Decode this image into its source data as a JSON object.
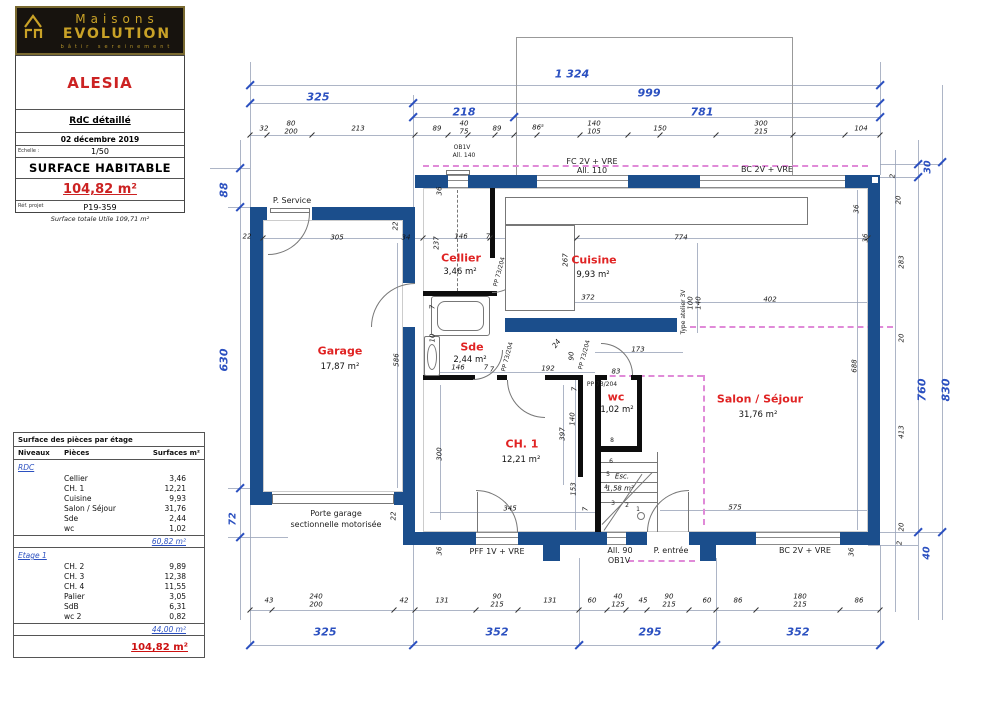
{
  "brand": {
    "line1": "Maisons",
    "line2": "EVOLUTION",
    "tagline": "bâtir sereinement"
  },
  "title_block": {
    "project": "ALESIA",
    "drawing": "RdC détaillé",
    "date": "02 décembre 2019",
    "scale_label": "Echelle :",
    "scale": "1/50",
    "surface_title": "SURFACE HABITABLE",
    "surface_value": "104,82 m²",
    "ref_label": "Réf. projet",
    "ref": "P19-359"
  },
  "note": "Surface totale Utile 109,71 m²",
  "surface_table": {
    "title": "Surface des pièces par étage",
    "columns": [
      "Niveaux",
      "Pièces",
      "Surfaces m²"
    ],
    "sections": [
      {
        "level": "RDC",
        "rows": [
          [
            "Cellier",
            "3,46"
          ],
          [
            "CH. 1",
            "12,21"
          ],
          [
            "Cuisine",
            "9,93"
          ],
          [
            "Salon / Séjour",
            "31,76"
          ],
          [
            "Sde",
            "2,44"
          ],
          [
            "wc",
            "1,02"
          ]
        ],
        "subtotal": "60,82 m²"
      },
      {
        "level": "Etage 1",
        "rows": [
          [
            "CH. 2",
            "9,89"
          ],
          [
            "CH. 3",
            "12,38"
          ],
          [
            "CH. 4",
            "11,55"
          ],
          [
            "Palier",
            "3,05"
          ],
          [
            "SdB",
            "6,31"
          ],
          [
            "wc 2",
            "0,82"
          ]
        ],
        "subtotal": "44,00 m²"
      }
    ],
    "total": "104,82 m²"
  },
  "colors": {
    "wall": "#1b4e8c",
    "dim_total": "#2b50c0",
    "room_label": "#e02323",
    "ceiling_dash": "#e08ad8",
    "brand_gold": "#c9a227",
    "logo_bg": "#17130e"
  },
  "plan": {
    "labels": [
      [
        "1 324",
        "total",
        572,
        74
      ],
      [
        "325",
        "total",
        318,
        97
      ],
      [
        "999",
        "total",
        649,
        93
      ],
      [
        "218",
        "total",
        464,
        112
      ],
      [
        "781",
        "total",
        702,
        112
      ],
      [
        "32",
        "dim",
        264,
        129
      ],
      [
        "80",
        "dim",
        291,
        124
      ],
      [
        "200",
        "dim",
        291,
        132
      ],
      [
        "213",
        "dim",
        358,
        129
      ],
      [
        "89",
        "dim",
        437,
        129
      ],
      [
        "40",
        "dim",
        464,
        124
      ],
      [
        "75",
        "dim",
        464,
        132
      ],
      [
        "OB1V",
        "tiny",
        462,
        148
      ],
      [
        "All. 140",
        "tiny",
        464,
        156
      ],
      [
        "89",
        "dim",
        497,
        129
      ],
      [
        "86⁵",
        "dim",
        538,
        128
      ],
      [
        "140",
        "dim",
        594,
        124
      ],
      [
        "105",
        "dim",
        594,
        132
      ],
      [
        "150",
        "dim",
        660,
        129
      ],
      [
        "300",
        "dim",
        761,
        124
      ],
      [
        "215",
        "dim",
        761,
        132
      ],
      [
        "104",
        "dim",
        861,
        129
      ],
      [
        "FC 2V + VRE",
        "ann",
        592,
        162
      ],
      [
        "All. 110",
        "ann",
        592,
        171
      ],
      [
        "BC 2V + VRE",
        "ann",
        767,
        170
      ],
      [
        "P. Service",
        "ann",
        292,
        201
      ],
      [
        "88",
        "total",
        224,
        190,
        -90
      ],
      [
        "630",
        "total",
        224,
        360,
        -90
      ],
      [
        "72",
        "total2",
        233,
        519,
        -90
      ],
      [
        "22",
        "dim",
        247,
        237
      ],
      [
        "305",
        "dim",
        337,
        238
      ],
      [
        "34",
        "dim",
        406,
        238
      ],
      [
        "22",
        "dim",
        396,
        226,
        -90
      ],
      [
        "586",
        "dim",
        397,
        360,
        -90
      ],
      [
        "Garage",
        "room",
        340,
        351
      ],
      [
        "17,87 m²",
        "area",
        340,
        367
      ],
      [
        "22",
        "dim",
        394,
        516,
        -90
      ],
      [
        "36",
        "dim",
        440,
        551,
        -90
      ],
      [
        "36",
        "dim",
        440,
        191,
        -90
      ],
      [
        "237",
        "dim",
        437,
        243,
        -90
      ],
      [
        "146",
        "dim",
        461,
        237
      ],
      [
        "7",
        "dim",
        488,
        237
      ],
      [
        "Cellier",
        "room",
        461,
        258
      ],
      [
        "3,46 m²",
        "area",
        460,
        272
      ],
      [
        "PP 73/204",
        "tiny",
        500,
        272,
        -75
      ],
      [
        "Sde",
        "room",
        472,
        347
      ],
      [
        "2,44 m²",
        "area",
        470,
        360
      ],
      [
        "146",
        "dim",
        458,
        368
      ],
      [
        "7",
        "dim",
        486,
        368
      ],
      [
        "7",
        "dim",
        433,
        307,
        -90
      ],
      [
        "10",
        "dim",
        433,
        338,
        -90
      ],
      [
        "PP 73/204",
        "tiny",
        508,
        357,
        -75
      ],
      [
        "Cuisine",
        "room",
        594,
        260
      ],
      [
        "9,93 m²",
        "area",
        593,
        275
      ],
      [
        "267",
        "dim",
        566,
        260,
        -90
      ],
      [
        "774",
        "dim",
        681,
        238
      ],
      [
        "36",
        "dim",
        866,
        238,
        -90
      ],
      [
        "372",
        "dim",
        588,
        298
      ],
      [
        "402",
        "dim",
        770,
        300
      ],
      [
        "100",
        "dim",
        691,
        303,
        -90
      ],
      [
        "140",
        "dim",
        699,
        303,
        -90
      ],
      [
        "Type atelier 3V",
        "tiny",
        684,
        312,
        -90
      ],
      [
        "36",
        "dim",
        857,
        209,
        -90
      ],
      [
        "192",
        "dim",
        548,
        369
      ],
      [
        "24",
        "dim",
        557,
        344,
        -55
      ],
      [
        "90",
        "dim",
        572,
        356,
        -90
      ],
      [
        "PP 73/204",
        "tiny",
        585,
        355,
        -75
      ],
      [
        "173",
        "dim",
        638,
        350
      ],
      [
        "83",
        "dim",
        616,
        372
      ],
      [
        "PP 73/204",
        "tiny",
        602,
        385
      ],
      [
        "wc",
        "room",
        616,
        397
      ],
      [
        "1,02 m²",
        "area",
        617,
        410
      ],
      [
        "8",
        "tiny",
        612,
        441
      ],
      [
        "6",
        "tiny",
        611,
        462
      ],
      [
        "5",
        "tiny",
        608,
        475
      ],
      [
        "Esc.",
        "esc",
        622,
        477
      ],
      [
        "4",
        "tiny",
        606,
        488
      ],
      [
        "1,58 m²",
        "esc",
        620,
        489
      ],
      [
        "3",
        "tiny",
        613,
        504
      ],
      [
        "2",
        "tiny",
        627,
        506
      ],
      [
        "1",
        "tiny",
        638,
        510
      ],
      [
        "140",
        "dim",
        573,
        419,
        -90
      ],
      [
        "397",
        "dim",
        563,
        434,
        -90
      ],
      [
        "7",
        "dim",
        575,
        389,
        -90
      ],
      [
        "153",
        "dim",
        574,
        489,
        -90
      ],
      [
        "7",
        "dim",
        586,
        509,
        -90
      ],
      [
        "CH. 1",
        "room",
        522,
        444
      ],
      [
        "12,21 m²",
        "area",
        521,
        460
      ],
      [
        "300",
        "dim",
        440,
        454,
        -90
      ],
      [
        "345",
        "dim",
        510,
        509
      ],
      [
        "7",
        "dim",
        492,
        370
      ],
      [
        "Salon / Séjour",
        "room",
        760,
        399
      ],
      [
        "31,76 m²",
        "area",
        758,
        415
      ],
      [
        "688",
        "dim",
        855,
        366,
        -90
      ],
      [
        "575",
        "dim",
        735,
        508
      ],
      [
        "30",
        "total2",
        928,
        167,
        -90
      ],
      [
        "2",
        "dim",
        893,
        176,
        -90
      ],
      [
        "20",
        "dim",
        899,
        200,
        -90
      ],
      [
        "283",
        "dim",
        902,
        262,
        -90
      ],
      [
        "20",
        "dim",
        902,
        338,
        -90
      ],
      [
        "413",
        "dim",
        902,
        432,
        -90
      ],
      [
        "760",
        "total",
        922,
        390,
        -90
      ],
      [
        "830",
        "total",
        946,
        390,
        -90
      ],
      [
        "20",
        "dim",
        902,
        527,
        -90
      ],
      [
        "2",
        "dim",
        900,
        543,
        -90
      ],
      [
        "40",
        "total2",
        927,
        553,
        -90
      ],
      [
        "36",
        "dim",
        852,
        552,
        -90
      ],
      [
        "Porte garage",
        "ann",
        336,
        514
      ],
      [
        "sectionnelle motorisée",
        "ann",
        336,
        525
      ],
      [
        "PFF 1V + VRE",
        "ann",
        497,
        552
      ],
      [
        "All. 90",
        "ann",
        620,
        551
      ],
      [
        "OB1V",
        "ann",
        619,
        561
      ],
      [
        "P. entrée",
        "ann",
        671,
        551
      ],
      [
        "BC 2V + VRE",
        "ann",
        805,
        551
      ],
      [
        "43",
        "dim",
        269,
        601
      ],
      [
        "240",
        "dim",
        316,
        597
      ],
      [
        "200",
        "dim",
        316,
        605
      ],
      [
        "42",
        "dim",
        404,
        601
      ],
      [
        "131",
        "dim",
        442,
        601
      ],
      [
        "90",
        "dim",
        497,
        597
      ],
      [
        "215",
        "dim",
        497,
        605
      ],
      [
        "131",
        "dim",
        550,
        601
      ],
      [
        "60",
        "dim",
        592,
        601
      ],
      [
        "40",
        "dim",
        618,
        597
      ],
      [
        "125",
        "dim",
        618,
        605
      ],
      [
        "45",
        "dim",
        643,
        601
      ],
      [
        "90",
        "dim",
        669,
        597
      ],
      [
        "215",
        "dim",
        669,
        605
      ],
      [
        "60",
        "dim",
        707,
        601
      ],
      [
        "86",
        "dim",
        738,
        601
      ],
      [
        "180",
        "dim",
        800,
        597
      ],
      [
        "215",
        "dim",
        800,
        605
      ],
      [
        "86",
        "dim",
        859,
        601
      ],
      [
        "325",
        "total",
        325,
        632
      ],
      [
        "352",
        "total",
        497,
        632
      ],
      [
        "295",
        "total",
        650,
        632
      ],
      [
        "352",
        "total",
        798,
        632
      ]
    ]
  }
}
